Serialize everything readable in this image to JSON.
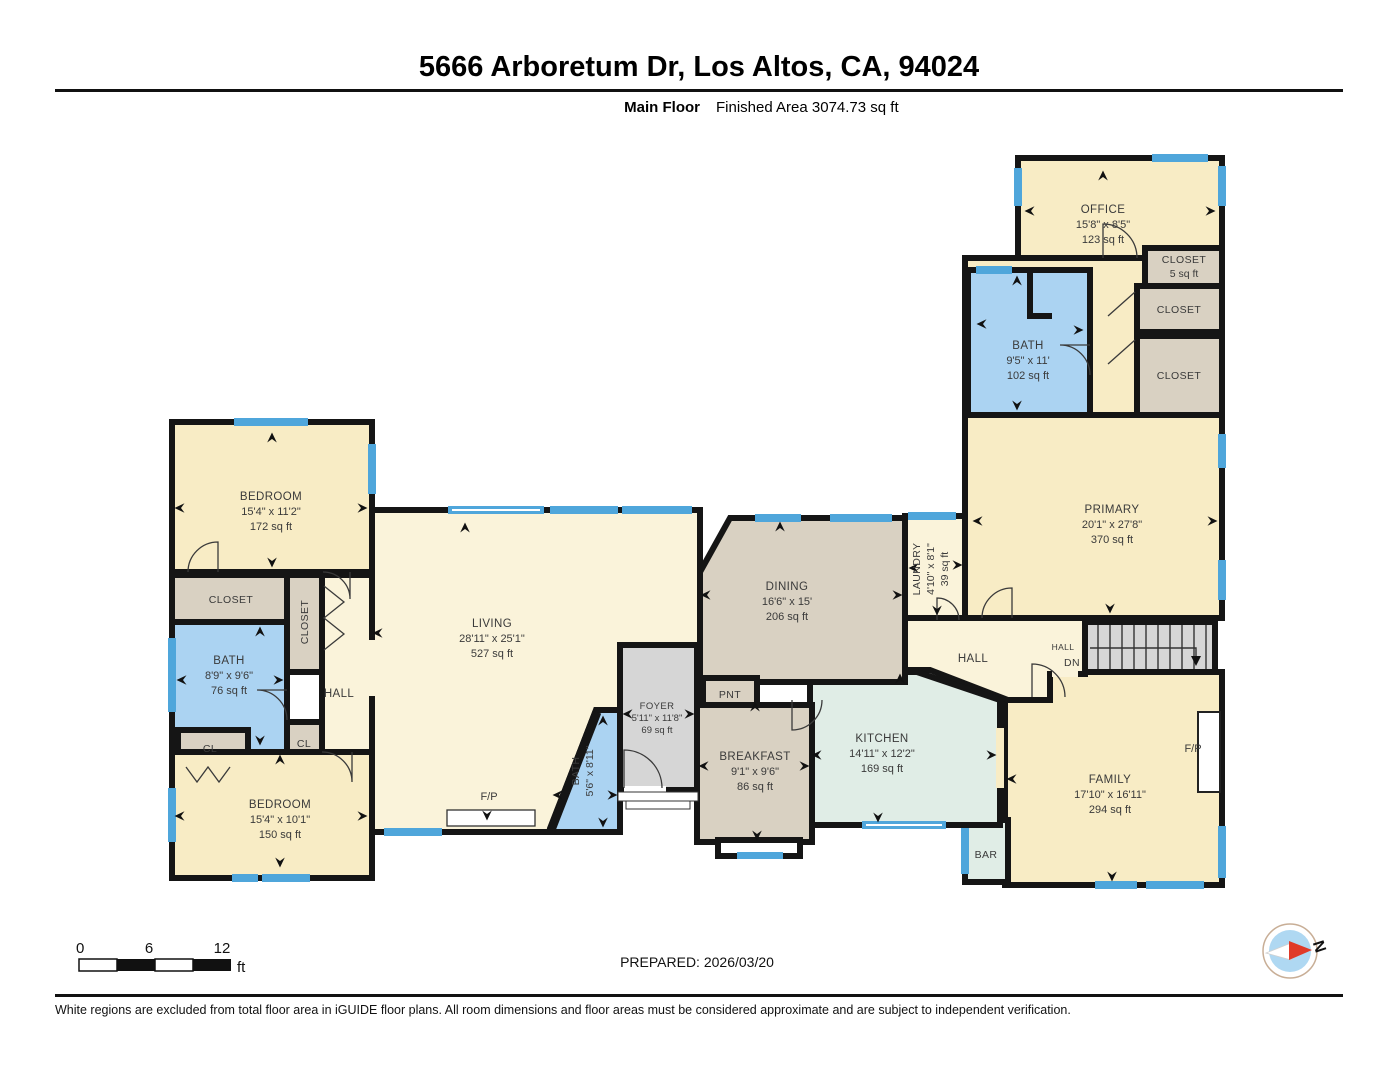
{
  "header": {
    "title": "5666 Arboretum Dr, Los Altos, CA, 94024",
    "floor_label": "Main Floor",
    "area_label": "Finished Area 3074.73 sq ft"
  },
  "rooms": {
    "office": {
      "name": "OFFICE",
      "dims": "15'8\" x 8'5\"",
      "area": "123 sq ft"
    },
    "closet_small": {
      "name": "CLOSET",
      "area": "5 sq ft"
    },
    "closet_upper": {
      "name": "CLOSET"
    },
    "closet_lower": {
      "name": "CLOSET"
    },
    "bath_primary": {
      "name": "BATH",
      "dims": "9'5\" x 11'",
      "area": "102 sq ft"
    },
    "primary": {
      "name": "PRIMARY",
      "dims": "20'1\" x 27'8\"",
      "area": "370 sq ft"
    },
    "laundry": {
      "name": "LAUNDRY",
      "dims": "4'10\" x 8'1\"",
      "area": "39 sq ft"
    },
    "hall_right": {
      "name": "HALL"
    },
    "hall_stairs": {
      "name": "HALL"
    },
    "stairs_dn": {
      "name": "DN"
    },
    "family": {
      "name": "FAMILY",
      "dims": "17'10\" x 16'11\"",
      "area": "294 sq ft"
    },
    "family_fireplace": {
      "name": "F/P"
    },
    "bar": {
      "name": "BAR"
    },
    "kitchen": {
      "name": "KITCHEN",
      "dims": "14'11\" x 12'2\"",
      "area": "169 sq ft"
    },
    "breakfast": {
      "name": "BREAKFAST",
      "dims": "9'1\" x 9'6\"",
      "area": "86 sq ft"
    },
    "pantry": {
      "name": "PNT"
    },
    "dining": {
      "name": "DINING",
      "dims": "16'6\" x 15'",
      "area": "206 sq ft"
    },
    "foyer": {
      "name": "FOYER",
      "dims": "5'11\" x 11'8\"",
      "area": "69 sq ft"
    },
    "living": {
      "name": "LIVING",
      "dims": "28'11\" x 25'1\"",
      "area": "527 sq ft"
    },
    "living_fireplace": {
      "name": "F/P"
    },
    "bath_center": {
      "name": "BATH",
      "dims": "5'6\" x 8'11\""
    },
    "bedroom_top": {
      "name": "BEDROOM",
      "dims": "15'4\" x 11'2\"",
      "area": "172 sq ft"
    },
    "closet_left": {
      "name": "CLOSET"
    },
    "closet_hall": {
      "name": "CLOSET"
    },
    "bath_left": {
      "name": "BATH",
      "dims": "8'9\" x 9'6\"",
      "area": "76 sq ft"
    },
    "hall_left": {
      "name": "HALL"
    },
    "cl_left": {
      "name": "CL"
    },
    "cl_mid": {
      "name": "CL"
    },
    "bedroom_bottom": {
      "name": "BEDROOM",
      "dims": "15'4\" x 10'1\"",
      "area": "150 sq ft"
    }
  },
  "scale_bar": {
    "start": "0",
    "mid": "6",
    "end": "12",
    "unit": "ft"
  },
  "prepared": "PREPARED: 2026/03/20",
  "compass_label": "N",
  "footer": "White regions are excluded from total floor area in iGUIDE floor plans. All room dimensions and floor areas must be considered approximate and are subject to independent verification.",
  "colors": {
    "wall": "#151515",
    "window": "#4FA6DB",
    "room_cream": "#F8ECC5",
    "room_pale": "#FAF3DA",
    "room_tan": "#D9D1C2",
    "room_bath_blue": "#ABD3F2",
    "room_kitchen_green": "#E0EDE6",
    "room_gray": "#D6D6D6",
    "compass_red": "#E03A28",
    "compass_blue": "#AFD8F2"
  }
}
